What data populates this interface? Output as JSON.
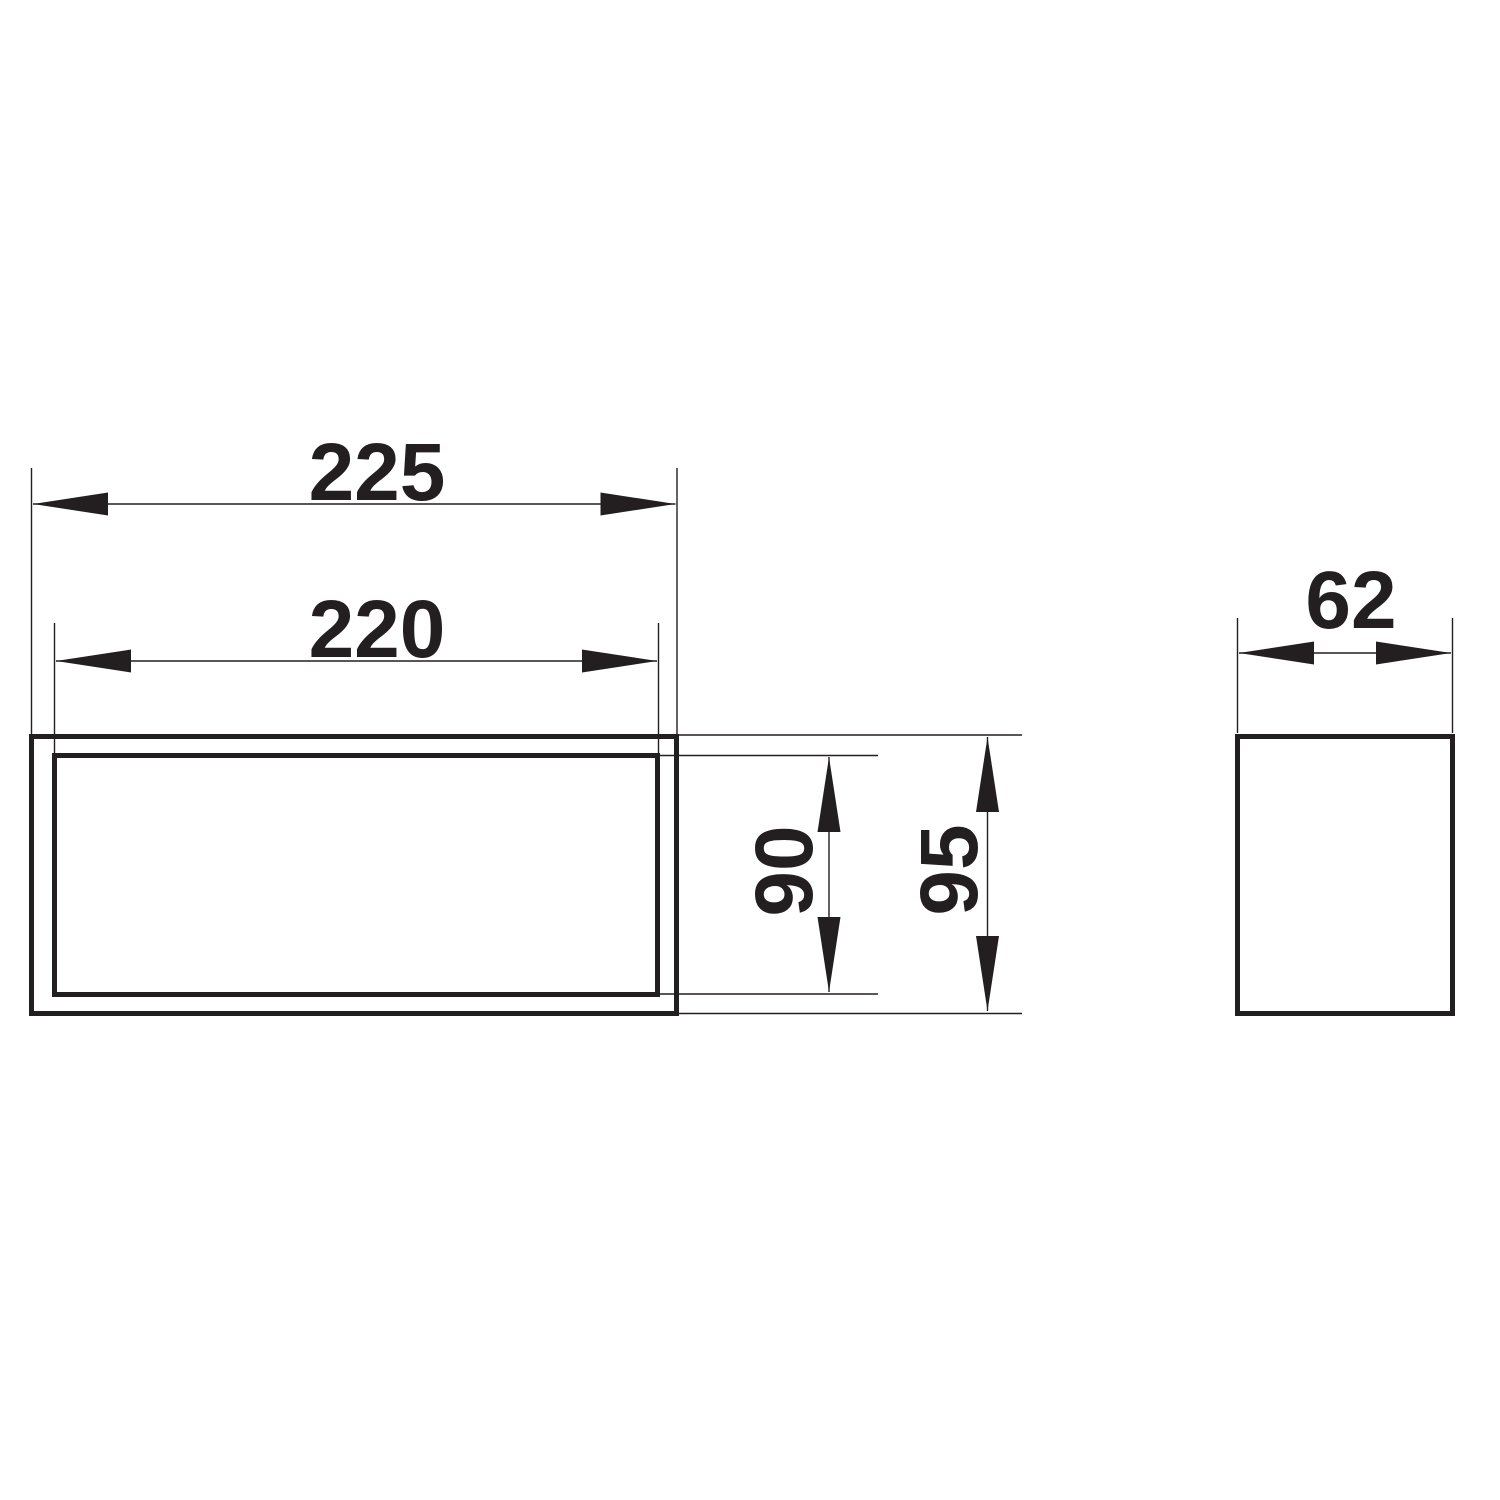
{
  "drawing": {
    "background_color": "#ffffff",
    "line_color": "#231f20",
    "front_view": {
      "outer_width_label": "225",
      "inner_width_label": "220",
      "inner_height_label": "90",
      "outer_height_label": "95"
    },
    "side_view": {
      "depth_label": "62"
    }
  }
}
